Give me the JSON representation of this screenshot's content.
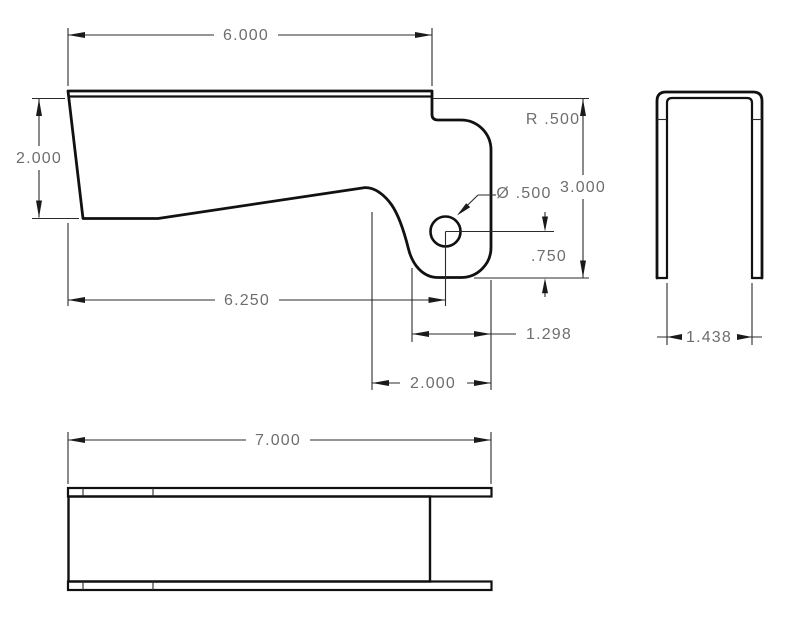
{
  "drawing": {
    "background_color": "#ffffff",
    "line_color": "#111111",
    "dim_text_color": "#6e6e6e",
    "dimensions": {
      "side_top_width": "6.000",
      "side_left_height": "2.000",
      "side_corner_radius": "R .500",
      "side_hole_diameter": "Ø .500",
      "side_overall_height": "3.000",
      "side_hole_from_bottom": ".750",
      "side_hole_from_left": "6.250",
      "side_hook_inner_width": "1.298",
      "side_hook_width": "2.000",
      "end_inner_width": "1.438",
      "top_overall_length": "7.000"
    }
  }
}
